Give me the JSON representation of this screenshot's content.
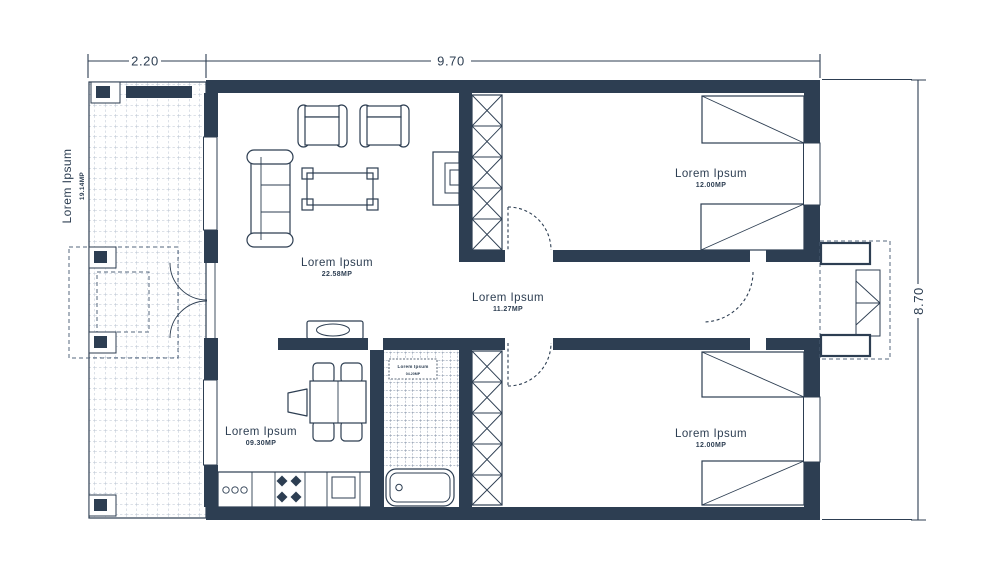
{
  "colors": {
    "ink": "#2d3e52",
    "terrace_hatch": "#b9c3d1",
    "bath_tile": "#7e8da3",
    "background": "#ffffff"
  },
  "dimensions": {
    "terrace_width": "2.20",
    "body_width": "9.70",
    "body_height": "8.70"
  },
  "terrace": {
    "label": "Lorem Ipsum",
    "area": "19.14MP"
  },
  "rooms": {
    "living": {
      "label": "Lorem Ipsum",
      "area": "22.58MP"
    },
    "hallway": {
      "label": "Lorem Ipsum",
      "area": "11.27MP"
    },
    "bedroom_top": {
      "label": "Lorem Ipsum",
      "area": "12.00MP"
    },
    "bedroom_bottom": {
      "label": "Lorem Ipsum",
      "area": "12.00MP"
    },
    "kitchen": {
      "label": "Lorem Ipsum",
      "area": "09.30MP"
    },
    "bathroom": {
      "label": "Lorem Ipsum",
      "area": "04.20MP"
    }
  }
}
